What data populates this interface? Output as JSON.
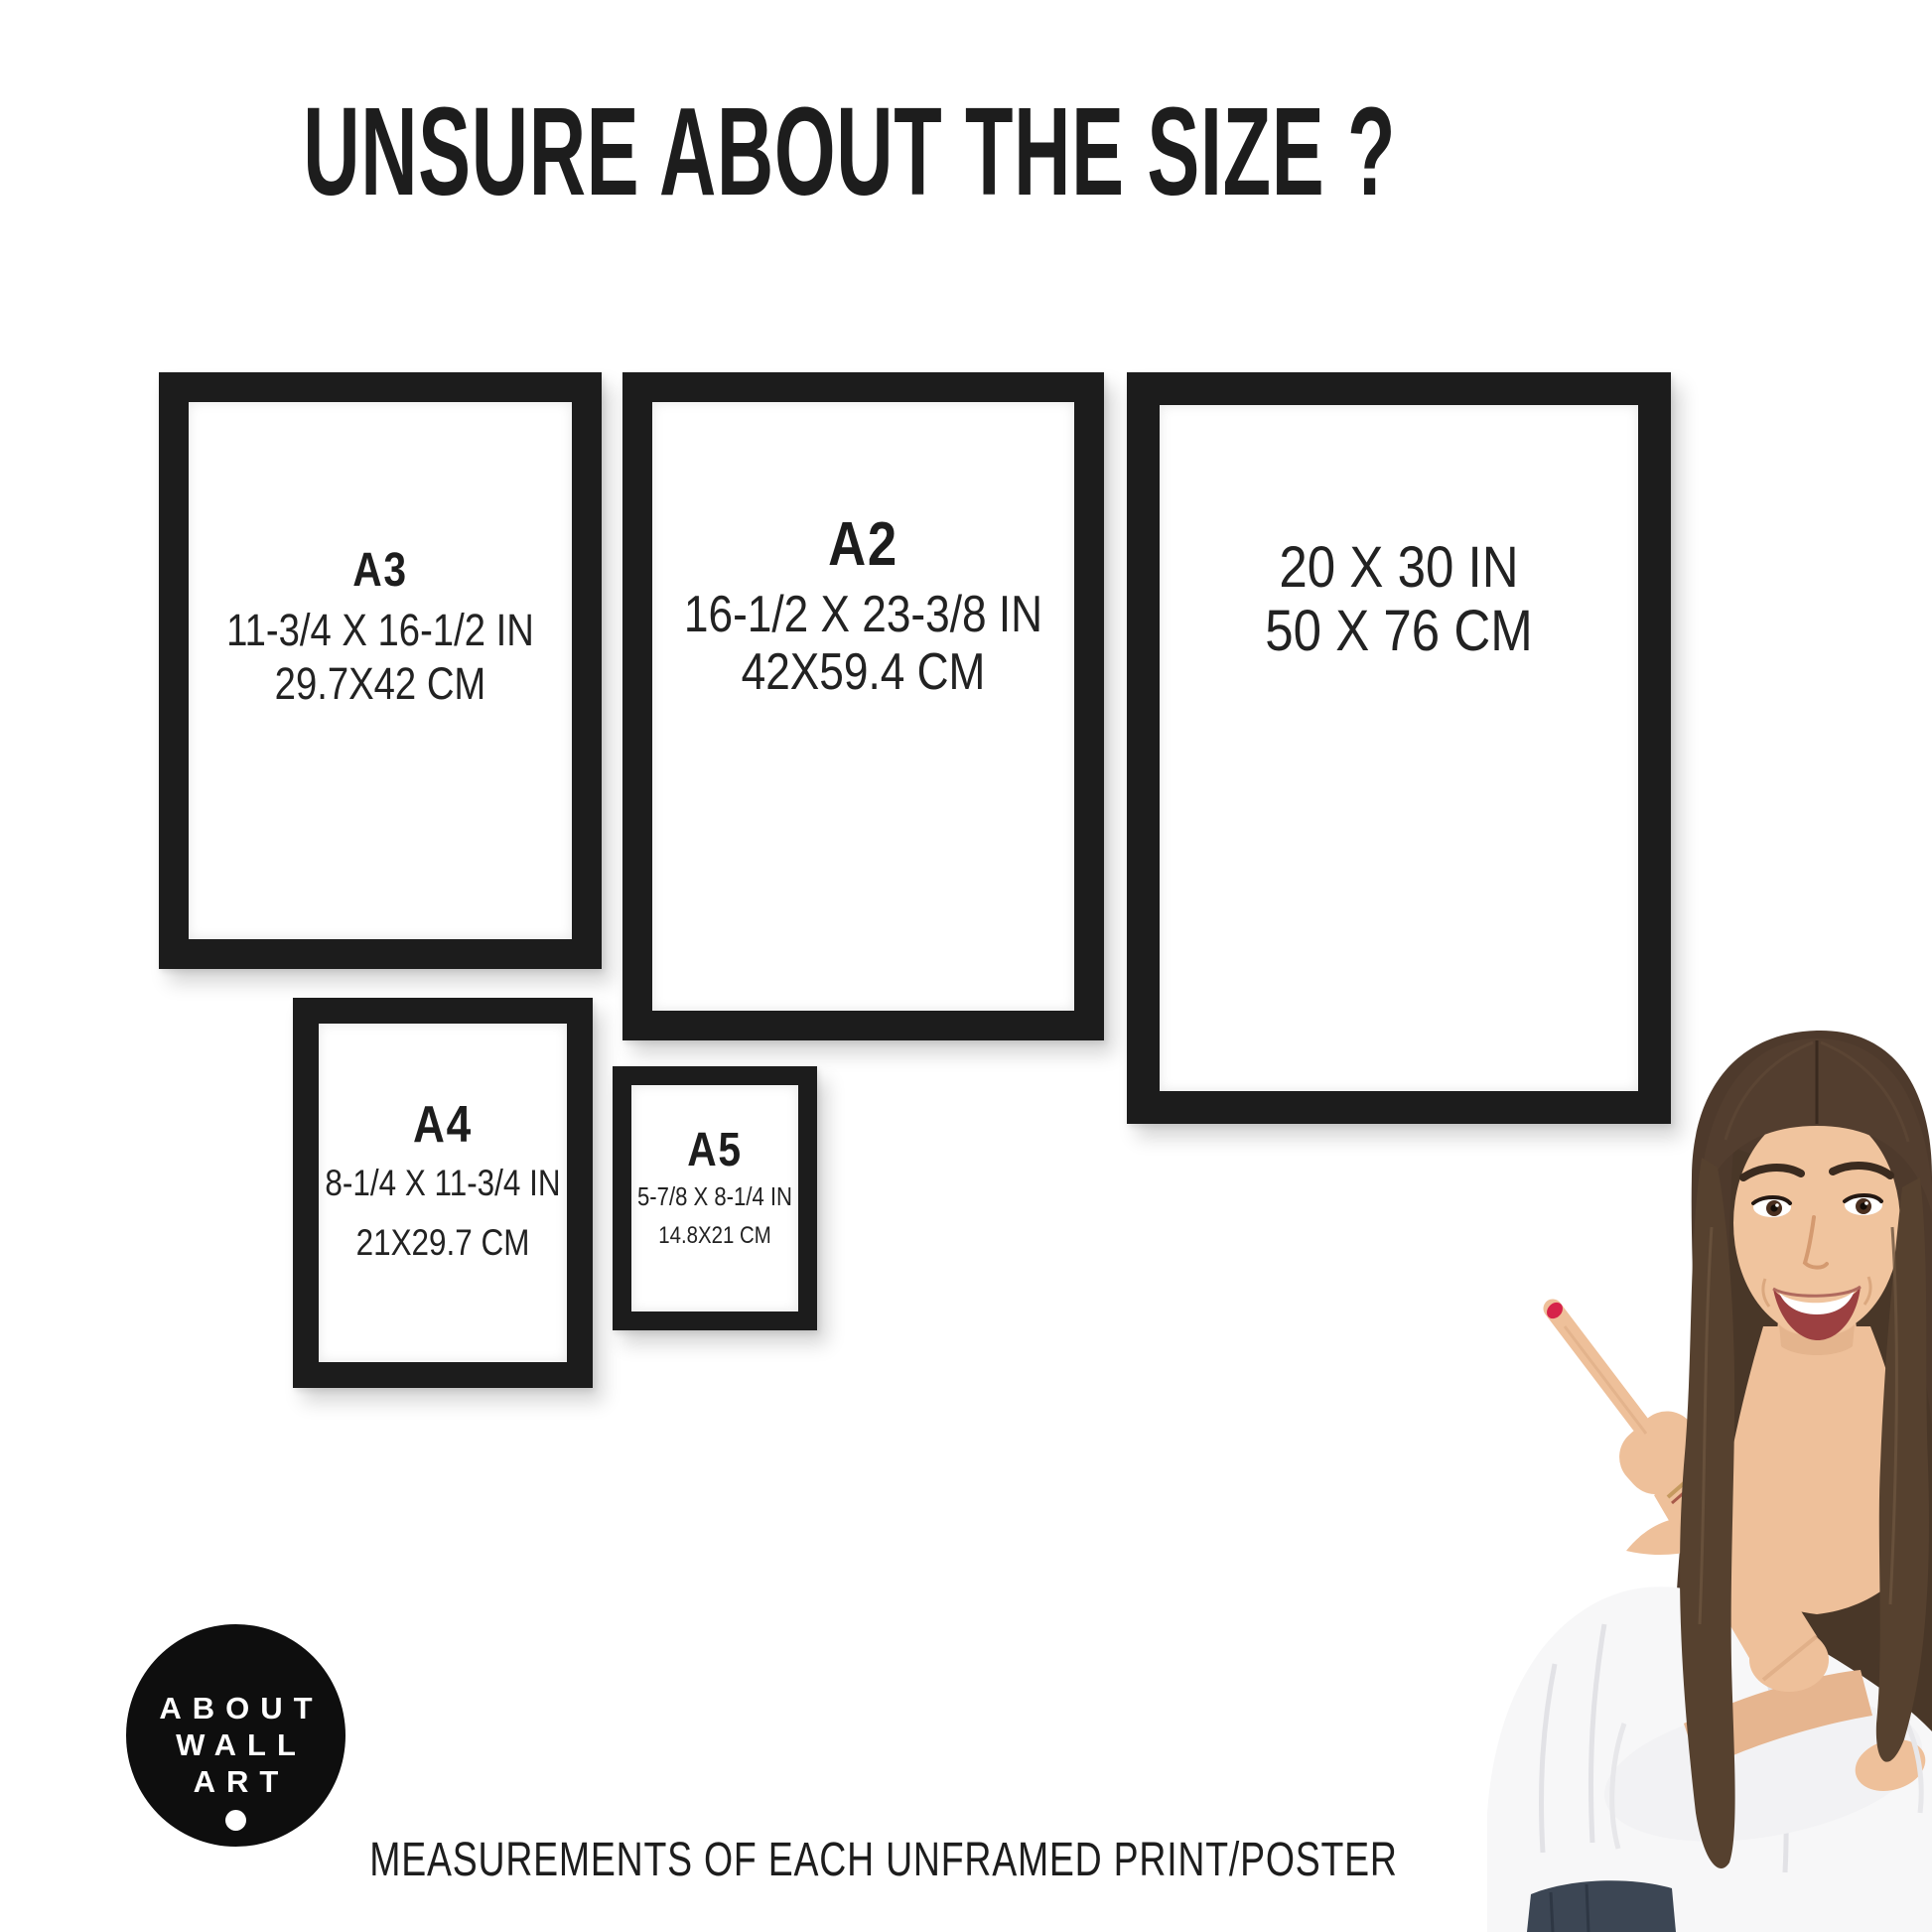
{
  "page": {
    "title": "UNSURE ABOUT THE SIZE ?",
    "footer": "MEASUREMENTS OF EACH UNFRAMED PRINT/POSTER"
  },
  "frames": [
    {
      "name": "A3",
      "inches": "11-3/4 X 16-1/2 IN",
      "cm": "29.7X42 CM"
    },
    {
      "name": "A2",
      "inches": "16-1/2 X 23-3/8 IN",
      "cm": "42X59.4 CM"
    },
    {
      "inches": "20 X 30 IN",
      "cm": "50 X 76 CM"
    },
    {
      "name": "A4",
      "inches": "8-1/4 X 11-3/4 IN",
      "cm": "21X29.7 CM"
    },
    {
      "name": "A5",
      "inches": "5-7/8 X 8-1/4 IN",
      "cm": "14.8X21 CM"
    }
  ],
  "logo": {
    "line1": "ABOUT",
    "line2": "WALL",
    "line3": "ART"
  },
  "colors": {
    "frame_black": "#1c1c1c",
    "text_black": "#1d1d1d",
    "logo_background": "#0e0e0e",
    "nail_red": "#d6244a"
  }
}
